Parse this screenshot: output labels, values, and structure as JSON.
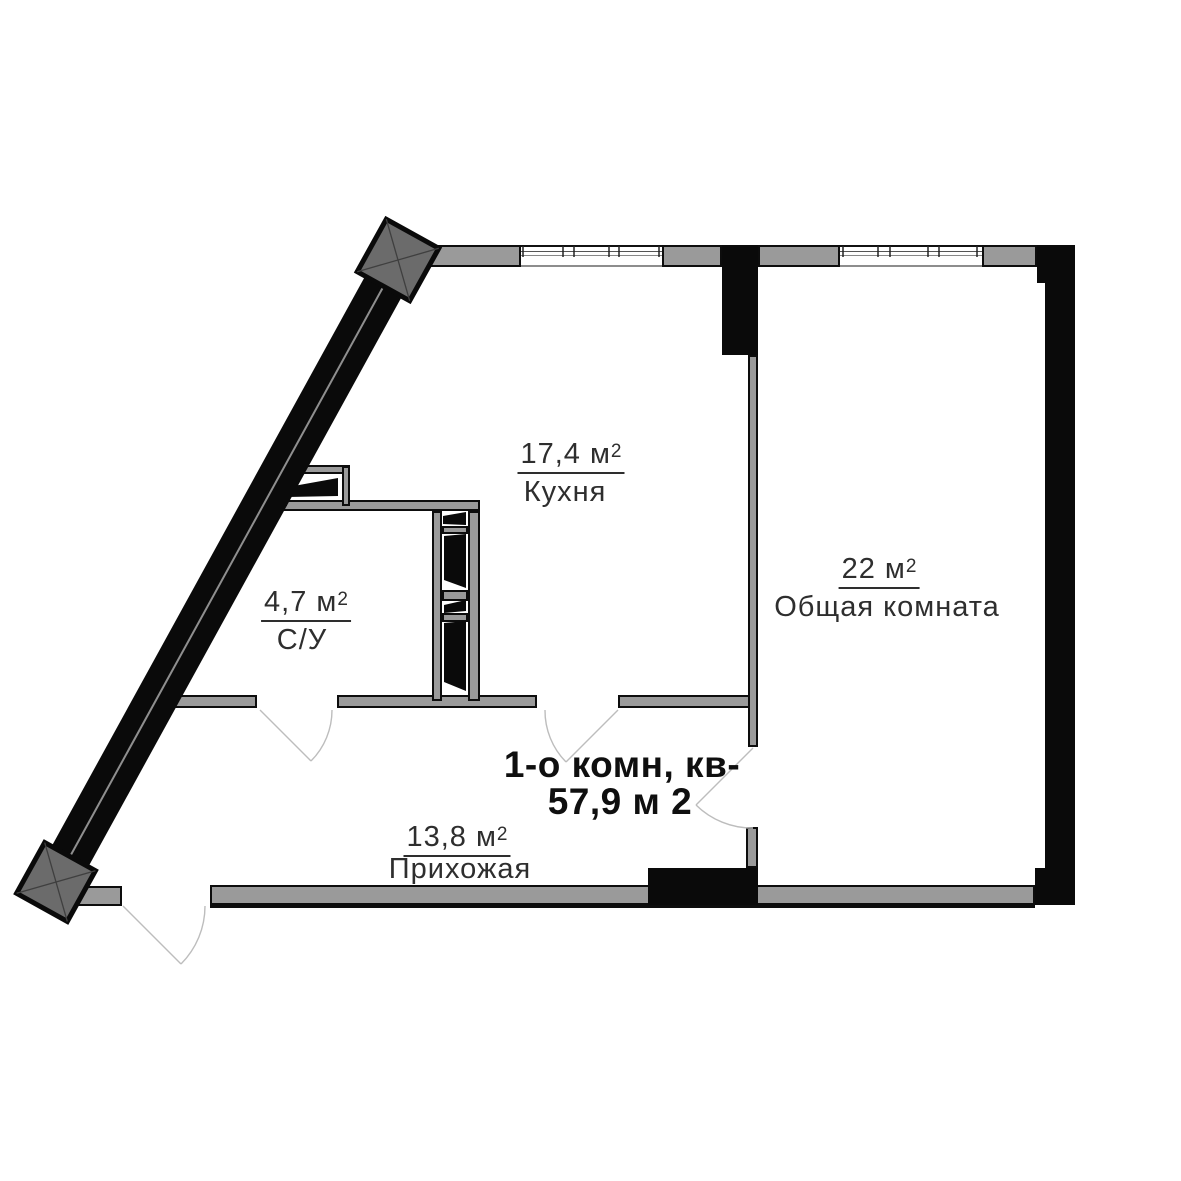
{
  "apartment": {
    "summary_line1": "1-о комн, кв-",
    "summary_line2": "57,9 м 2"
  },
  "rooms": {
    "kitchen": {
      "area": "17,4 м",
      "area_sup": "2",
      "name": "Кухня"
    },
    "living_room": {
      "area": "22 м",
      "area_sup": "2",
      "name": "Общая комната"
    },
    "bathroom": {
      "area": "4,7 м",
      "area_sup": "2",
      "name": "С/У"
    },
    "hallway": {
      "area": "13,8 м",
      "area_sup": "2",
      "name": "Прихожая"
    }
  },
  "colors": {
    "wall_black": "#0a0a0a",
    "wall_gray": "#9a9a9a",
    "column_marker_gray": "#6b6b6b",
    "label_text": "#2e2e2e",
    "title_text": "#0f0f0f",
    "door_arc": "#bdbdbd"
  }
}
